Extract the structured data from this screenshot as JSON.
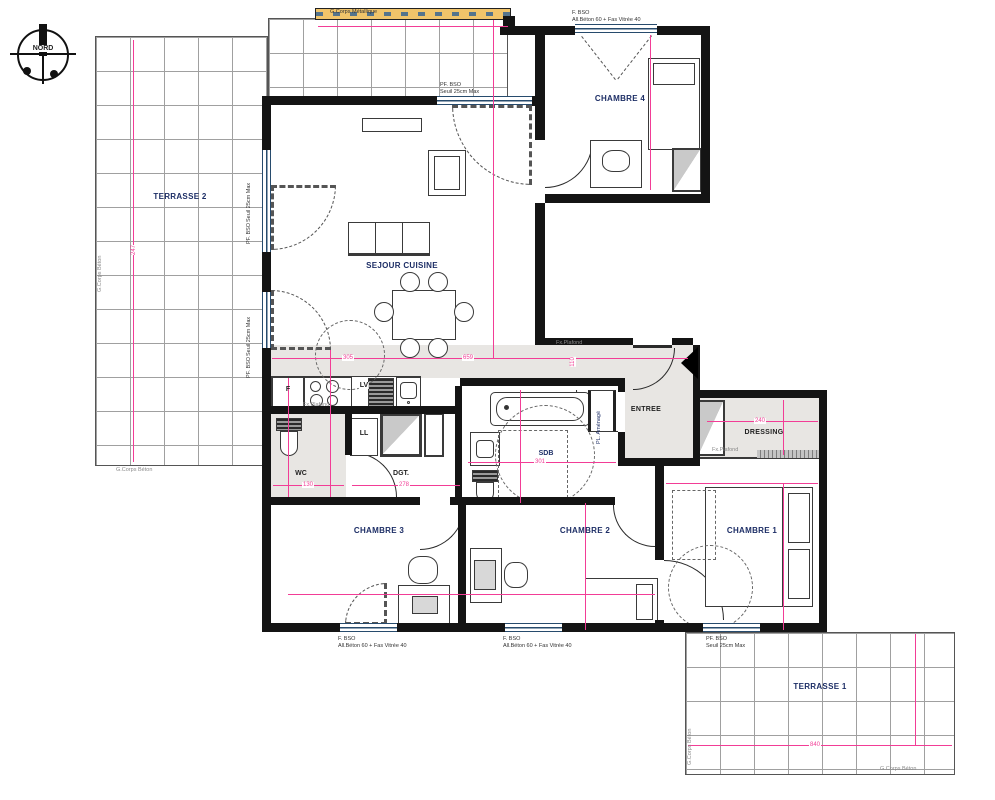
{
  "compass": {
    "label": "NORD"
  },
  "rooms": {
    "terrasse2": "TERRASSE 2",
    "sejour": "SEJOUR CUISINE",
    "chambre4": "CHAMBRE 4",
    "chambre3": "CHAMBRE 3",
    "chambre2": "CHAMBRE 2",
    "chambre1": "CHAMBRE 1",
    "entree": "ENTREE",
    "dressing": "DRESSING",
    "sdb": "SDB",
    "wc": "WC",
    "dgt": "DGT.",
    "terrasse1": "TERRASSE 1"
  },
  "kitchen": {
    "fridge": "F",
    "dishwasher": "LV",
    "washer": "LL"
  },
  "notes": {
    "metal_frame": "G.Corps Métallique",
    "concrete_frame": "G.Corps Béton",
    "pf_bso": "PF. BSO",
    "pf_detail": "Seuil 25cm Max",
    "f_bso": "F. BSO",
    "f_detail": "All.Béton 60 + Fas Vitrée 40",
    "false_ceiling": "Fx.Plafond",
    "fitted_closet": "PL. Aménagé"
  },
  "dims": {
    "t2_h": "247",
    "hall_a": "305",
    "hall_b": "659",
    "hall_h": "110",
    "wc_w": "130",
    "dgt_w": "278",
    "sdb_w": "301",
    "dressing_w": "240",
    "t1_w": "840"
  },
  "colors": {
    "dim_line": "#f23d96",
    "wall": "#141414",
    "soft_floor": "#e8e6e3",
    "awning": "#f1c46a",
    "window_frame": "#274b6d"
  }
}
